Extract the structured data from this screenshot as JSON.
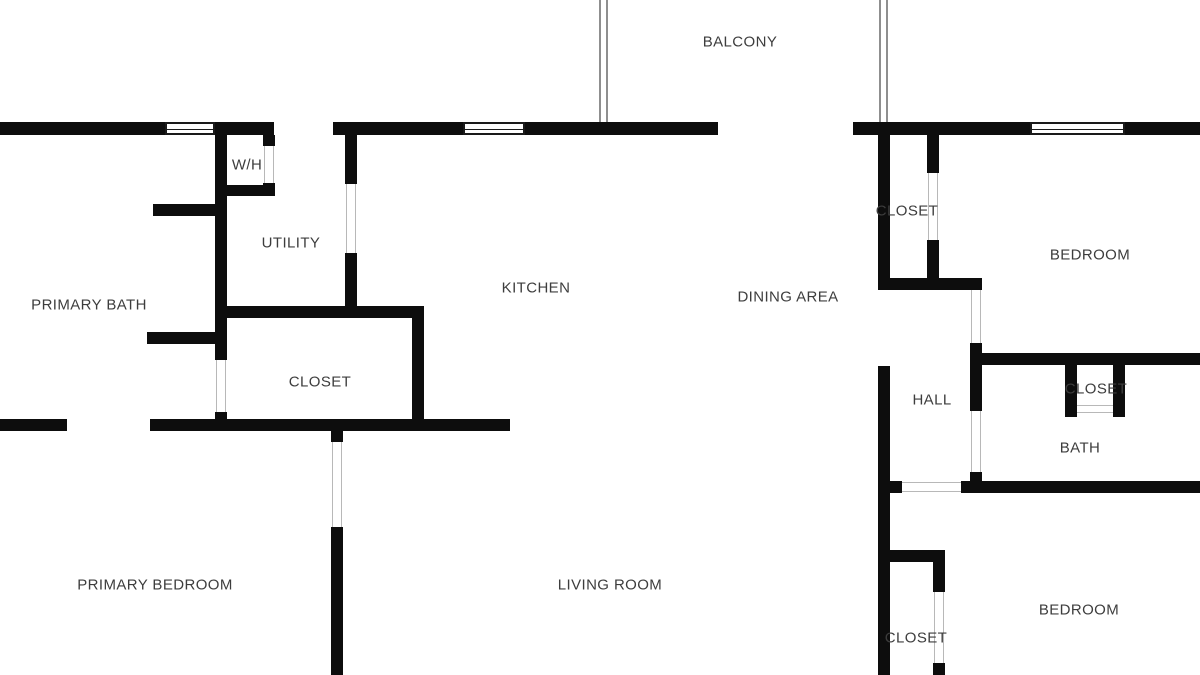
{
  "plan": {
    "colors": {
      "background": "#ffffff",
      "wall": "#0d0d0d",
      "label": "#3d3d3d",
      "door_jamb": "#b8b8b8",
      "railing": "#8f8f8f",
      "window_frame": "#1a1a1a"
    },
    "rooms": [
      {
        "id": "balcony",
        "label": "BALCONY",
        "x": 740,
        "y": 42
      },
      {
        "id": "water-heater",
        "label": "W/H",
        "x": 247,
        "y": 165
      },
      {
        "id": "utility",
        "label": "UTILITY",
        "x": 291,
        "y": 243
      },
      {
        "id": "primary-bath",
        "label": "PRIMARY BATH",
        "x": 89,
        "y": 305
      },
      {
        "id": "closet-primary",
        "label": "CLOSET",
        "x": 320,
        "y": 382
      },
      {
        "id": "kitchen",
        "label": "KITCHEN",
        "x": 536,
        "y": 288
      },
      {
        "id": "dining-area",
        "label": "DINING AREA",
        "x": 788,
        "y": 297
      },
      {
        "id": "primary-bedroom",
        "label": "PRIMARY BEDROOM",
        "x": 155,
        "y": 585
      },
      {
        "id": "living-room",
        "label": "LIVING ROOM",
        "x": 610,
        "y": 585
      },
      {
        "id": "closet-bedroom1",
        "label": "CLOSET",
        "x": 907,
        "y": 211
      },
      {
        "id": "bedroom1",
        "label": "BEDROOM",
        "x": 1090,
        "y": 255
      },
      {
        "id": "hall",
        "label": "HALL",
        "x": 932,
        "y": 400
      },
      {
        "id": "closet-bath",
        "label": "CLOSET",
        "x": 1096,
        "y": 389
      },
      {
        "id": "bath",
        "label": "BATH",
        "x": 1080,
        "y": 448
      },
      {
        "id": "closet-bedroom2",
        "label": "CLOSET",
        "x": 916,
        "y": 638
      },
      {
        "id": "bedroom2",
        "label": "BEDROOM",
        "x": 1079,
        "y": 610
      }
    ],
    "walls": [
      {
        "x": 0,
        "y": 122,
        "w": 165,
        "h": 13
      },
      {
        "x": 215,
        "y": 122,
        "w": 59,
        "h": 13
      },
      {
        "x": 333,
        "y": 122,
        "w": 130,
        "h": 13
      },
      {
        "x": 525,
        "y": 122,
        "w": 193,
        "h": 13
      },
      {
        "x": 853,
        "y": 122,
        "w": 177,
        "h": 13
      },
      {
        "x": 1125,
        "y": 122,
        "w": 75,
        "h": 13
      },
      {
        "x": 215,
        "y": 135,
        "w": 12,
        "h": 225
      },
      {
        "x": 215,
        "y": 412,
        "w": 12,
        "h": 9
      },
      {
        "x": 263,
        "y": 135,
        "w": 12,
        "h": 11
      },
      {
        "x": 263,
        "y": 183,
        "w": 12,
        "h": 13
      },
      {
        "x": 215,
        "y": 185,
        "w": 60,
        "h": 11
      },
      {
        "x": 153,
        "y": 204,
        "w": 64,
        "h": 12
      },
      {
        "x": 147,
        "y": 332,
        "w": 71,
        "h": 12
      },
      {
        "x": 345,
        "y": 135,
        "w": 12,
        "h": 49
      },
      {
        "x": 345,
        "y": 253,
        "w": 12,
        "h": 65
      },
      {
        "x": 221,
        "y": 306,
        "w": 202,
        "h": 12
      },
      {
        "x": 412,
        "y": 306,
        "w": 12,
        "h": 125
      },
      {
        "x": 0,
        "y": 419,
        "w": 67,
        "h": 12
      },
      {
        "x": 150,
        "y": 419,
        "w": 360,
        "h": 12
      },
      {
        "x": 331,
        "y": 431,
        "w": 12,
        "h": 11
      },
      {
        "x": 331,
        "y": 527,
        "w": 12,
        "h": 148
      },
      {
        "x": 878,
        "y": 135,
        "w": 12,
        "h": 155
      },
      {
        "x": 878,
        "y": 366,
        "w": 12,
        "h": 309
      },
      {
        "x": 927,
        "y": 135,
        "w": 12,
        "h": 38
      },
      {
        "x": 927,
        "y": 240,
        "w": 12,
        "h": 40
      },
      {
        "x": 878,
        "y": 278,
        "w": 104,
        "h": 12
      },
      {
        "x": 970,
        "y": 343,
        "w": 12,
        "h": 68
      },
      {
        "x": 970,
        "y": 472,
        "w": 12,
        "h": 21
      },
      {
        "x": 970,
        "y": 353,
        "w": 230,
        "h": 12
      },
      {
        "x": 1065,
        "y": 365,
        "w": 12,
        "h": 52
      },
      {
        "x": 1113,
        "y": 365,
        "w": 12,
        "h": 52
      },
      {
        "x": 878,
        "y": 481,
        "w": 24,
        "h": 12
      },
      {
        "x": 961,
        "y": 481,
        "w": 239,
        "h": 12
      },
      {
        "x": 878,
        "y": 550,
        "w": 67,
        "h": 12
      },
      {
        "x": 933,
        "y": 550,
        "w": 12,
        "h": 42
      },
      {
        "x": 933,
        "y": 663,
        "w": 12,
        "h": 12
      }
    ],
    "windows": [
      {
        "x": 165,
        "y": 122,
        "w": 50,
        "h": 13
      },
      {
        "x": 463,
        "y": 122,
        "w": 62,
        "h": 13
      },
      {
        "x": 1030,
        "y": 122,
        "w": 95,
        "h": 13
      }
    ],
    "doors": [
      {
        "x": 264,
        "y": 146,
        "w": 10,
        "h": 37,
        "dir": "v"
      },
      {
        "x": 346,
        "y": 184,
        "w": 10,
        "h": 69,
        "dir": "v"
      },
      {
        "x": 216,
        "y": 360,
        "w": 10,
        "h": 52,
        "dir": "v"
      },
      {
        "x": 332,
        "y": 442,
        "w": 10,
        "h": 85,
        "dir": "v"
      },
      {
        "x": 928,
        "y": 173,
        "w": 10,
        "h": 67,
        "dir": "v"
      },
      {
        "x": 971,
        "y": 290,
        "w": 10,
        "h": 53,
        "dir": "v"
      },
      {
        "x": 971,
        "y": 411,
        "w": 10,
        "h": 61,
        "dir": "v"
      },
      {
        "x": 902,
        "y": 482,
        "w": 59,
        "h": 10,
        "dir": "h"
      },
      {
        "x": 934,
        "y": 592,
        "w": 10,
        "h": 71,
        "dir": "v"
      },
      {
        "x": 1077,
        "y": 405,
        "w": 36,
        "h": 8,
        "dir": "h"
      }
    ],
    "railings": [
      {
        "x": 599,
        "y": 0,
        "w": 9,
        "h": 122
      },
      {
        "x": 879,
        "y": 0,
        "w": 9,
        "h": 122
      }
    ]
  }
}
